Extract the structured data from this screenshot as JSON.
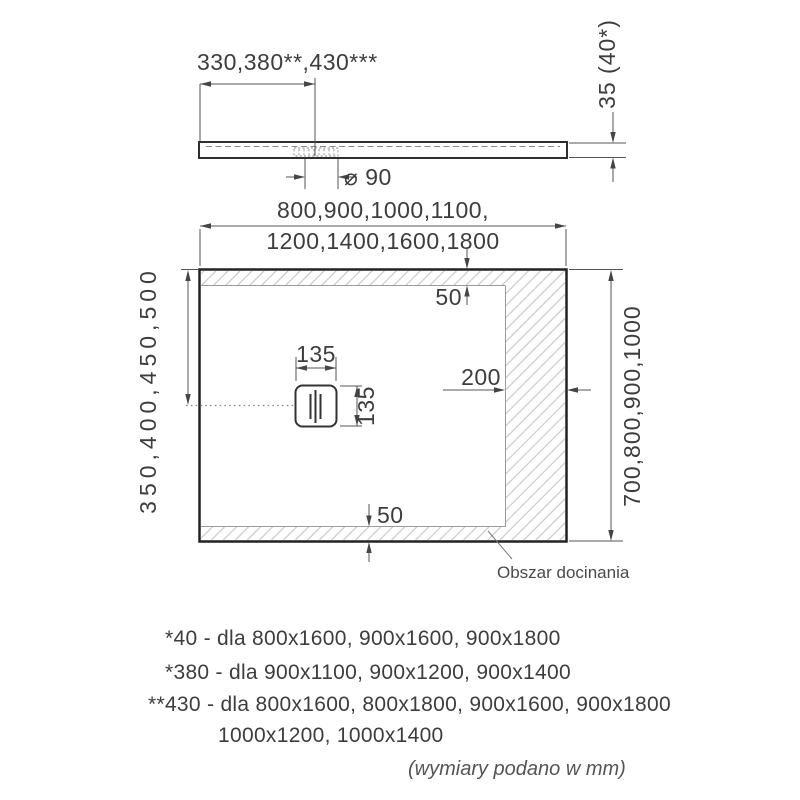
{
  "side_view": {
    "offset_dim": "330,380**,430***",
    "drain_diameter_dim": "⌀ 90",
    "thickness_dim": "35 (40*)"
  },
  "plan_view": {
    "width_dim_line1": "800,900,1000,1100,",
    "width_dim_line2": "1200,1400,1600,1800",
    "top_edge_dim": "50",
    "right_strip_dim": "200",
    "bottom_edge_dim": "50",
    "drain_width_dim": "135",
    "drain_height_dim": "135",
    "drain_offset_dim": "350,400,450,500",
    "height_dim": "700,800,900,1000",
    "trim_area_label": "Obszar docinania"
  },
  "footnotes": {
    "line1": "*40 - dla 800x1600, 900x1600, 900x1800",
    "line2": "*380 - dla 900x1100, 900x1200, 900x1400",
    "line3": "**430 - dla 800x1600, 800x1800, 900x1600, 900x1800",
    "line4": "1000x1200, 1000x1400",
    "units_note": "(wymiary podano w mm)"
  },
  "colors": {
    "line": "#2e2e2e",
    "dim_line": "#555555",
    "text": "#3d3d3d",
    "hatch": "#b8b8b8"
  }
}
